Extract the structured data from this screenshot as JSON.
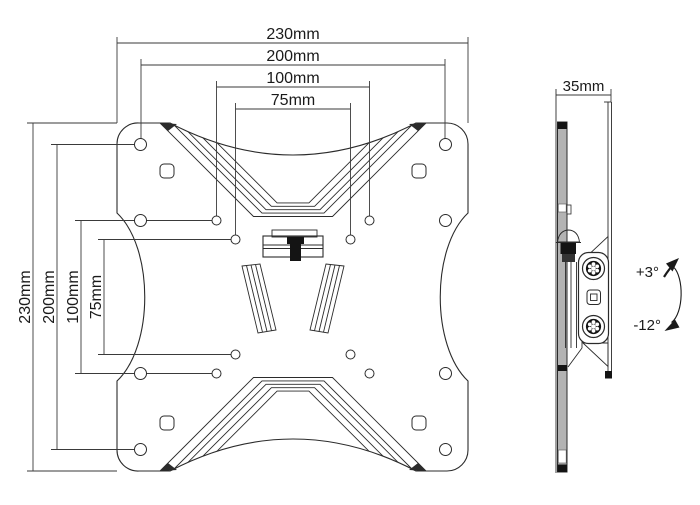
{
  "colors": {
    "background": "#ffffff",
    "line": "#2b2b2b",
    "metal_gray": "#b3b3b3",
    "detail_black": "#141414"
  },
  "front_view": {
    "dims_top": [
      "230mm",
      "200mm",
      "100mm",
      "75mm"
    ],
    "dims_left": [
      "230mm",
      "200mm",
      "100mm",
      "75mm"
    ]
  },
  "side_view": {
    "dim_depth": "35mm",
    "tilt_up": "+3°",
    "tilt_down": "-12°"
  }
}
